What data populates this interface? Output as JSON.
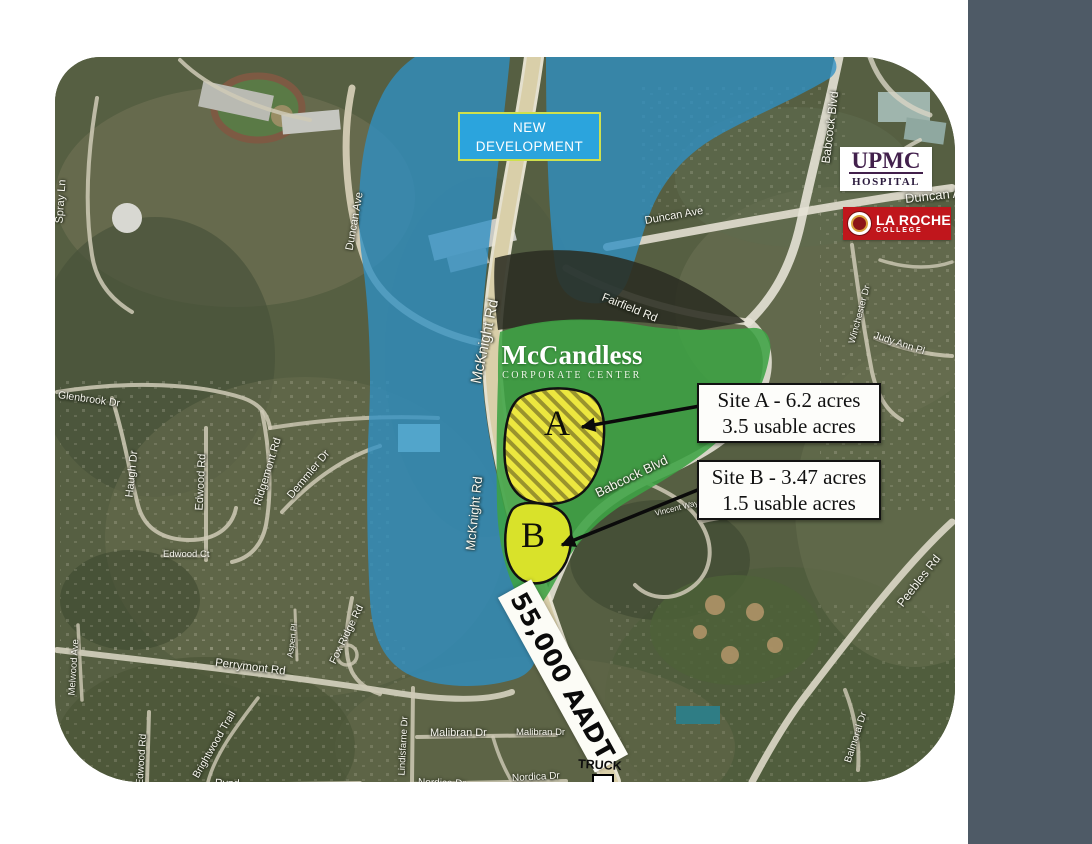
{
  "map": {
    "new_development": {
      "line1": "NEW",
      "line2": "DEVELOPMENT"
    },
    "mccandless": {
      "title": "McCandless",
      "subtitle": "CORPORATE CENTER"
    },
    "sites": {
      "a": {
        "letter": "A",
        "line1": "Site A - 6.2 acres",
        "line2": "3.5 usable acres"
      },
      "b": {
        "letter": "B",
        "line1": "Site B - 3.47 acres",
        "line2": "1.5 usable acres"
      }
    },
    "traffic": {
      "label": "55,000 AADT"
    },
    "truck": {
      "label": "TRUCK"
    },
    "landmarks": {
      "upmc": {
        "line1": "UPMC",
        "line2": "HOSPITAL"
      },
      "laroche": {
        "line1": "LA ROCHE",
        "line2": "COLLEGE"
      }
    },
    "road_labels": [
      {
        "label": "Spray Ln"
      },
      {
        "label": "Duncan Ave"
      },
      {
        "label": "Duncan Ave"
      },
      {
        "label": "Duncan Ave"
      },
      {
        "label": "Babcock Blvd"
      },
      {
        "label": "Babcock Blvd"
      },
      {
        "label": "Vincent Way"
      },
      {
        "label": "McKnight Rd"
      },
      {
        "label": "McKnight Rd"
      },
      {
        "label": "Fairfield Rd"
      },
      {
        "label": "Winchester Dr"
      },
      {
        "label": "Judy Ann Pl"
      },
      {
        "label": "Glenbrook Dr"
      },
      {
        "label": "Haugh Dr"
      },
      {
        "label": "Edwood Rd"
      },
      {
        "label": "Ridgemont Rd"
      },
      {
        "label": "Demmler Dr"
      },
      {
        "label": "Edwood Ct"
      },
      {
        "label": "Melwood Ave"
      },
      {
        "label": "Perrymont Rd"
      },
      {
        "label": "Aspen Pl"
      },
      {
        "label": "Fox Ridge Rd"
      },
      {
        "label": "Brightwood Trail"
      },
      {
        "label": "Edwood Rd"
      },
      {
        "label": "Rynd"
      },
      {
        "label": "Lindisfarne Dr"
      },
      {
        "label": "Malibran Dr"
      },
      {
        "label": "Malibran Dr"
      },
      {
        "label": "Nordica Dr"
      },
      {
        "label": "Nordica Dr"
      },
      {
        "label": "Peebles Rd"
      },
      {
        "label": "Balmoral Dr"
      }
    ]
  },
  "sidebar": {
    "grant_street": {
      "logo_letter": "G",
      "name": "GRANT STREET",
      "associates": "A S S O C I A T E S ,  I N C .",
      "tagline": "INDEPENDENTLY OWNED AND OPERATED"
    },
    "cushman_vertical": {
      "line1": "CUSHMAN&",
      "line2": "WAKEFIELD®"
    },
    "cushman_logo": {
      "line1": "CUSHMAN &",
      "line2": "WAKEFIELD"
    }
  },
  "colors": {
    "sidebar_bg": "#4e5a66",
    "overlay_blue": "#2e8fc4",
    "mccandless_green": "#3da344",
    "site_a_yellow": "#ece73f",
    "site_b_yellow": "#d9e22a",
    "laroche_red": "#c0161c",
    "upmc_purple": "#42204c",
    "new_dev_blue": "#2ba4dd"
  }
}
